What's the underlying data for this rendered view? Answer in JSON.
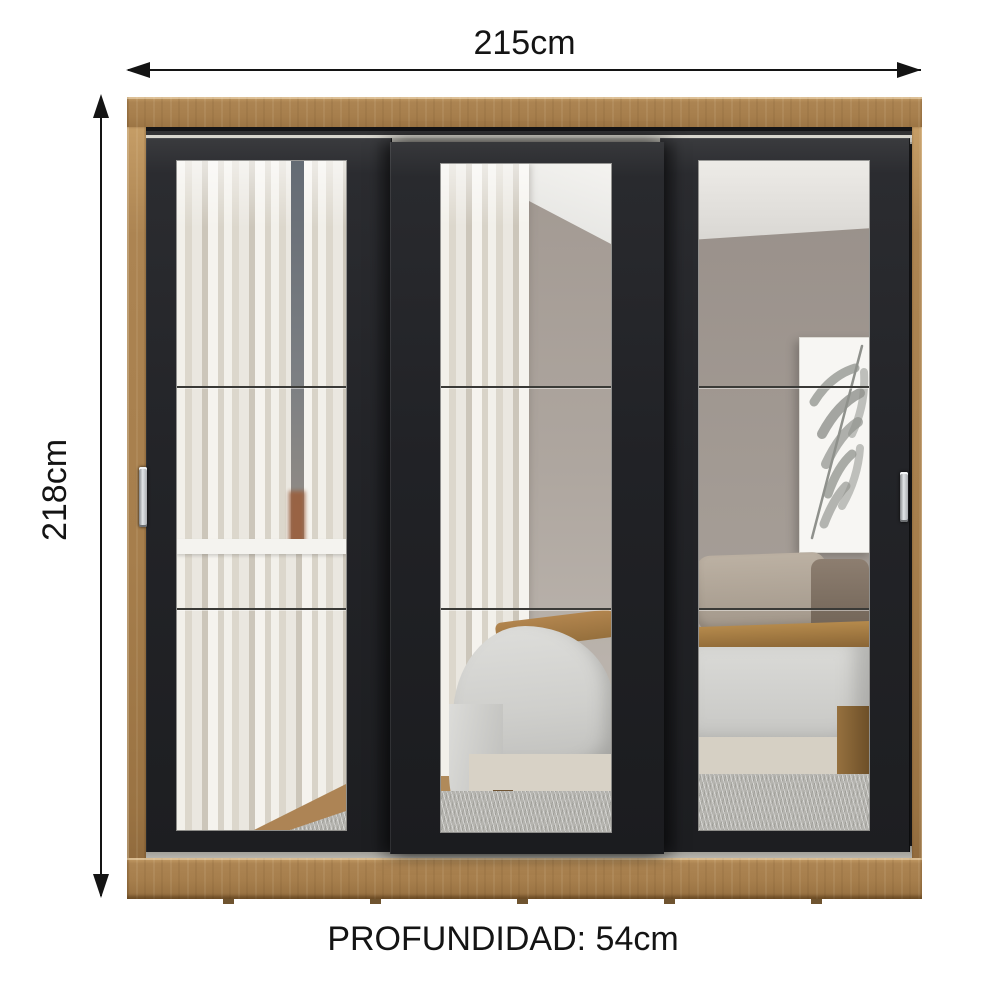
{
  "diagram": {
    "width_label": "215cm",
    "height_label": "218cm",
    "depth_label": "PROFUNDIDAD: 54cm"
  },
  "product": {
    "doors": 3,
    "mirror_panels_per_door": 3,
    "handles": 2,
    "colors": {
      "background": "#ffffff",
      "arrow": "#141414",
      "wood": "#a9824f",
      "door_black": "#232428",
      "track_silver": "#c2c0b8",
      "handle_silver": "#c8cbce",
      "mirror_wall_taupe": "#a69d96",
      "mirror_ceiling": "#efeeea",
      "curtain_white": "#e9e6df",
      "window_slit_blue": "#6a7179",
      "brick_red": "#9a5f3d",
      "bed_duvet_gray": "#cfcfcc",
      "bed_wood_tan": "#a57c48",
      "bed_base_beige": "#d6d0c4",
      "carpet_gray": "#b5b4af",
      "art_leaf_gray": "#8f918c"
    }
  }
}
